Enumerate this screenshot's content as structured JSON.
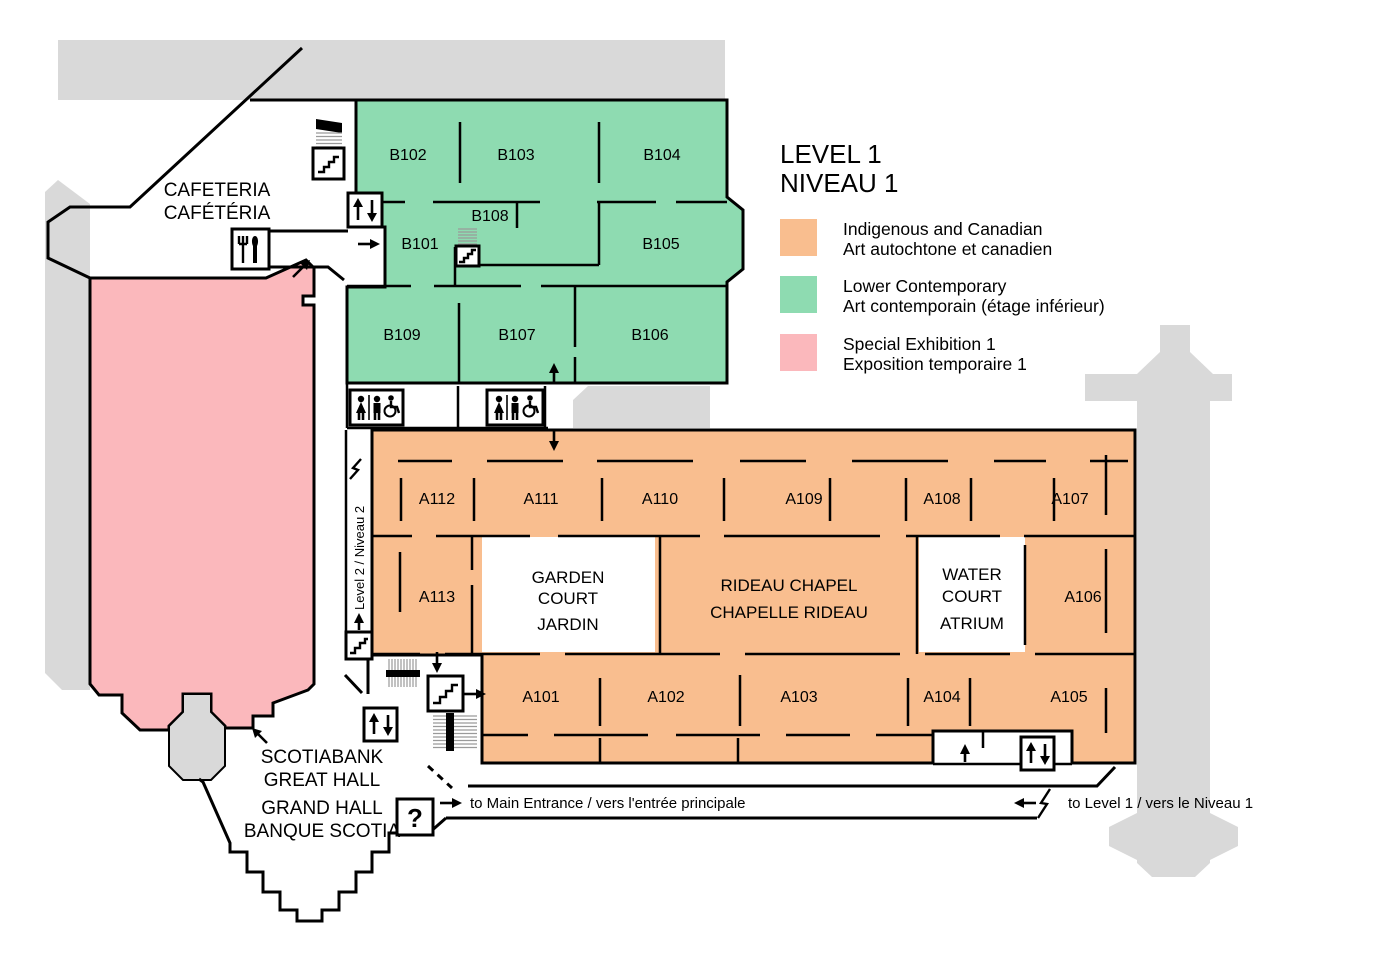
{
  "title": {
    "line1": "LEVEL 1",
    "line2": "NIVEAU 1"
  },
  "legend": {
    "items": [
      {
        "key": "indigenous-and-canadian",
        "color": "#F9BE8F",
        "en": "Indigenous and Canadian",
        "fr": "Art autochtone et canadien"
      },
      {
        "key": "lower-contemporary",
        "color": "#8EDBB1",
        "en": "Lower Contemporary",
        "fr": "Art contemporain (étage inférieur)"
      },
      {
        "key": "special-exhibition-1",
        "color": "#FBB8BC",
        "en": "Special Exhibition 1",
        "fr": "Exposition temporaire 1"
      }
    ]
  },
  "rooms": {
    "a101": "A101",
    "a102": "A102",
    "a103": "A103",
    "a104": "A104",
    "a105": "A105",
    "a106": "A106",
    "a107": "A107",
    "a108": "A108",
    "a109": "A109",
    "a110": "A110",
    "a111": "A111",
    "a112": "A112",
    "a113": "A113",
    "b101": "B101",
    "b102": "B102",
    "b103": "B103",
    "b104": "B104",
    "b105": "B105",
    "b106": "B106",
    "b107": "B107",
    "b108": "B108",
    "b109": "B109"
  },
  "places": {
    "cafeteria_en": "CAFETERIA",
    "cafeteria_fr": "CAFÉTÉRIA",
    "great_hall_line1": "SCOTIABANK",
    "great_hall_line2": "GREAT HALL",
    "great_hall_line3": "GRAND HALL",
    "great_hall_line4": "BANQUE SCOTIA",
    "garden_court_line1": "GARDEN",
    "garden_court_line2": "COURT",
    "garden_court_line3": "JARDIN",
    "rideau_chapel_line1": "RIDEAU CHAPEL",
    "rideau_chapel_line2": "CHAPELLE RIDEAU",
    "water_court_line1": "WATER",
    "water_court_line2": "COURT",
    "water_court_line3": "ATRIUM"
  },
  "annotations": {
    "level2_corridor": "Level 2 / Niveau 2",
    "to_main_entrance": "to Main Entrance / vers l'entrée principale",
    "to_level1": "to Level 1 / vers le Niveau 1",
    "info": "?"
  },
  "colors": {
    "wall": "#000000",
    "background": "#FFFFFF",
    "exterior_gray": "#D9D9D9"
  }
}
